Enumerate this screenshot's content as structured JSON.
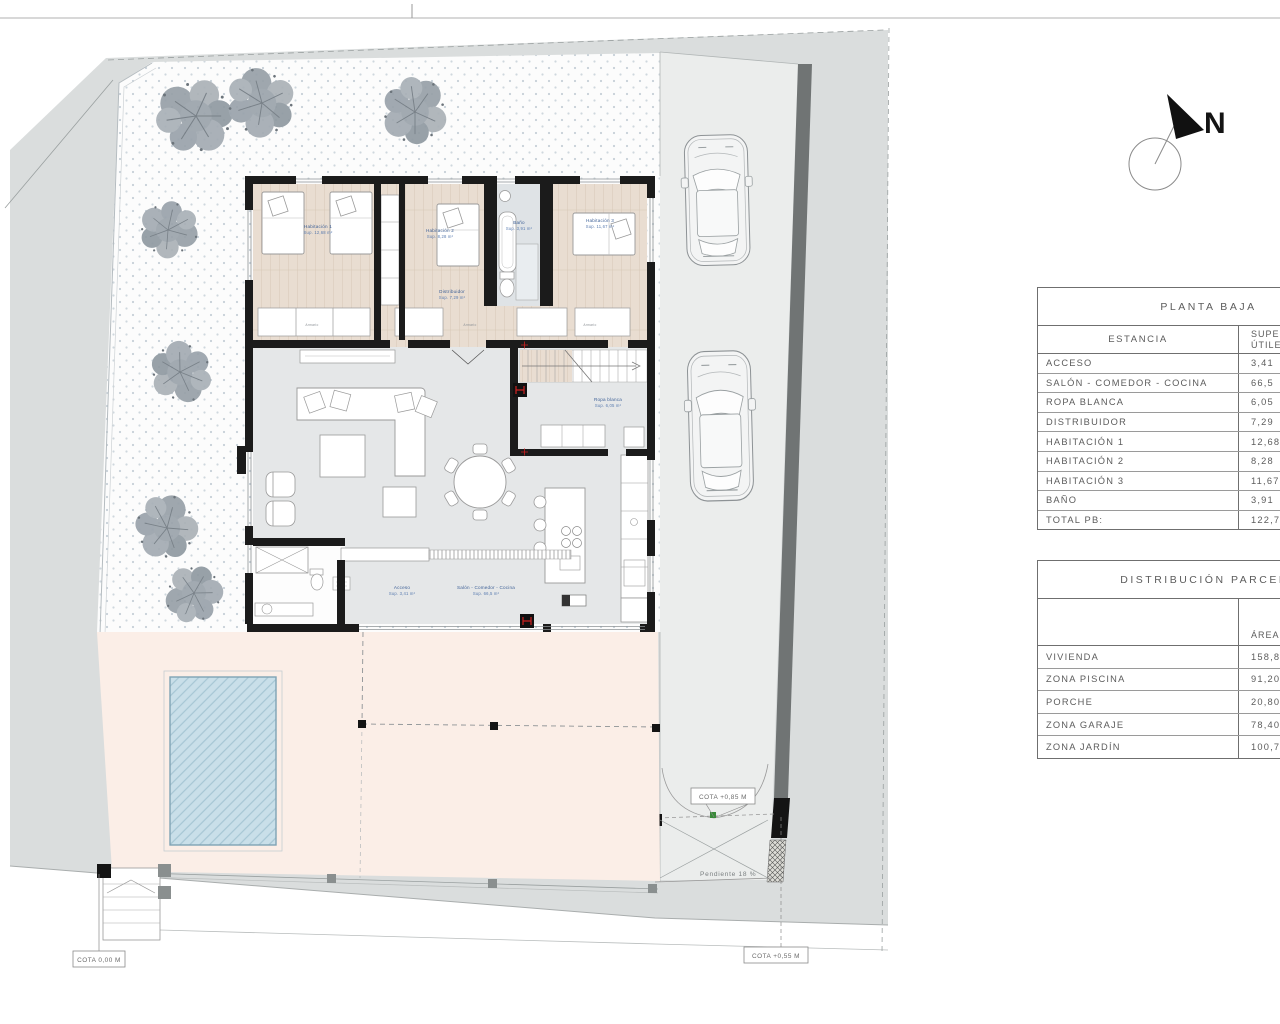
{
  "plan": {
    "north_label": "N",
    "cota_bottom_left": "COTA 0,00 M",
    "cota_street": "COTA +0,55 M",
    "cota_gate": "COTA +0,85 M",
    "slope_label": "Pendiente 18 %",
    "armario_label": "Armario",
    "rooms": {
      "hab1": {
        "name": "Habitación 1",
        "sup": "Sup. 12,68 m²"
      },
      "hab2": {
        "name": "Habitación 2",
        "sup": "Sup. 8,28 m²"
      },
      "hab3": {
        "name": "Habitación 3",
        "sup": "Sup. 11,67 m²"
      },
      "bano": {
        "name": "Baño",
        "sup": "Sup. 3,91 m²"
      },
      "distribuidor": {
        "name": "Distribuidor",
        "sup": "Sup. 7,29 m²"
      },
      "ropa": {
        "name": "Ropa blanca",
        "sup": "Sup. 6,05 m²"
      },
      "acceso": {
        "name": "Acceso",
        "sup": "Sup. 3,41 m²"
      },
      "salon": {
        "name": "Salón - Comedor - Cocina",
        "sup": "Sup. 66,5 m²"
      }
    }
  },
  "tables": {
    "planta_baja": {
      "title": "PLANTA BAJA",
      "col_estancia": "ESTANCIA",
      "col_sup_line1": "SUPERFICIES",
      "col_sup_line2": "ÚTILES",
      "rows": [
        {
          "label": "ACCESO",
          "value": "3,41"
        },
        {
          "label": "SALÓN - COMEDOR - COCINA",
          "value": "66,5"
        },
        {
          "label": "ROPA BLANCA",
          "value": "6,05"
        },
        {
          "label": "DISTRIBUIDOR",
          "value": "7,29"
        },
        {
          "label": "HABITACIÓN 1",
          "value": "12,68"
        },
        {
          "label": "HABITACIÓN 2",
          "value": "8,28"
        },
        {
          "label": "HABITACIÓN 3",
          "value": "11,67"
        },
        {
          "label": "BAÑO",
          "value": "3,91"
        }
      ],
      "total": {
        "label": "TOTAL PB:",
        "value": "122,7"
      }
    },
    "distribucion": {
      "title": "DISTRIBUCIÓN PARCELA",
      "col_area": "ÁREA",
      "rows": [
        {
          "label": "VIVIENDA",
          "value": "158,80"
        },
        {
          "label": "ZONA PISCINA",
          "value": "91,20"
        },
        {
          "label": "PORCHE",
          "value": "20,80"
        },
        {
          "label": "ZONA GARAJE",
          "value": "78,40"
        },
        {
          "label": "ZONA JARDÍN",
          "value": "100,78"
        }
      ]
    }
  },
  "colors": {
    "wall": "#1b1b1b",
    "wood_floor": "#e9ddd1",
    "living_floor": "#e5e7e8",
    "terrace": "#fbeee7",
    "pool": "#c9dfe9",
    "street": "#dadddd",
    "driveway": "#ebedec",
    "boundary_strip": "#707474",
    "tree": "#97a0a7",
    "label_blue": "#3c5f96",
    "marker_red": "#cc2222",
    "gate_marker_green": "#3a8a3a"
  }
}
